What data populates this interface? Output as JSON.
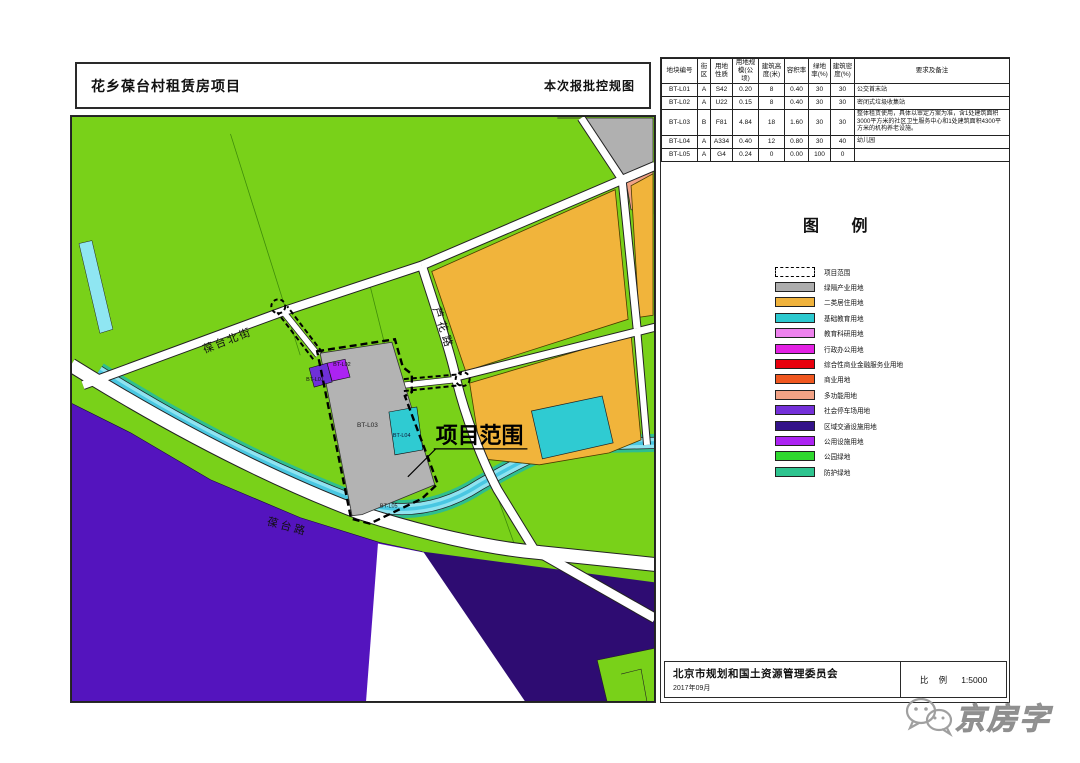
{
  "header": {
    "project_title": "花乡葆台村租赁房项目",
    "sheet_title": "本次报批控规图"
  },
  "table": {
    "headers": [
      "地块编号",
      "街区",
      "用地性质",
      "用地规模(公顷)",
      "建筑高度(米)",
      "容积率",
      "绿地率(%)",
      "建筑密度(%)",
      "要求及备注"
    ],
    "rows": [
      [
        "BT-L01",
        "A",
        "S42",
        "0.20",
        "8",
        "0.40",
        "30",
        "30",
        "公交首末站"
      ],
      [
        "BT-L02",
        "A",
        "U22",
        "0.15",
        "8",
        "0.40",
        "30",
        "30",
        "密闭式垃圾收集站"
      ],
      [
        "BT-L03",
        "B",
        "F81",
        "4.84",
        "18",
        "1.60",
        "30",
        "30",
        "整体租赁使用，具体以审定方案为准，含1处建筑面积3000平方米的社区卫生服务中心和1处建筑面积4300平方米的机构养老设施。"
      ],
      [
        "BT-L04",
        "A",
        "A334",
        "0.40",
        "12",
        "0.80",
        "30",
        "40",
        "幼儿园"
      ],
      [
        "BT-L05",
        "A",
        "G4",
        "0.24",
        "0",
        "0.00",
        "100",
        "0",
        ""
      ]
    ]
  },
  "legend": {
    "title": "图 例",
    "items": [
      {
        "label": "项目范围",
        "color": "#ffffff",
        "dash": true
      },
      {
        "label": "绿隔产业用地",
        "color": "#adadad"
      },
      {
        "label": "二类居住用地",
        "color": "#efb23c"
      },
      {
        "label": "基础教育用地",
        "color": "#2cc9cf"
      },
      {
        "label": "教育科研用地",
        "color": "#ee82ee"
      },
      {
        "label": "行政办公用地",
        "color": "#e321e3"
      },
      {
        "label": "综合性商业金融服务业用地",
        "color": "#e8000d"
      },
      {
        "label": "商业用地",
        "color": "#f0571f"
      },
      {
        "label": "多功能用地",
        "color": "#f2a285"
      },
      {
        "label": "社会停车场用地",
        "color": "#7430d9"
      },
      {
        "label": "区域交通设施用地",
        "color": "#331289"
      },
      {
        "label": "公用设施用地",
        "color": "#ac23f2"
      },
      {
        "label": "公园绿地",
        "color": "#2fd82f"
      },
      {
        "label": "防护绿地",
        "color": "#2ec48f"
      }
    ]
  },
  "map": {
    "labels": {
      "road_baotai_north": "葆台北街",
      "road_luhua": "芦花路",
      "road_baotai": "葆台路",
      "project_scope": "项目范围",
      "plot_bt_l01": "BT-L01",
      "plot_bt_l02": "BT-L02",
      "plot_bt_l03": "BT-L03",
      "plot_bt_l04": "BT-L04",
      "plot_bt_l05": "BT-L05"
    }
  },
  "footer": {
    "org_name": "北京市规划和国土资源管理委员会",
    "date": "2017年09月",
    "scale_label": "比  例",
    "scale_value": "1:5000"
  },
  "watermark": {
    "text": "京房字"
  }
}
